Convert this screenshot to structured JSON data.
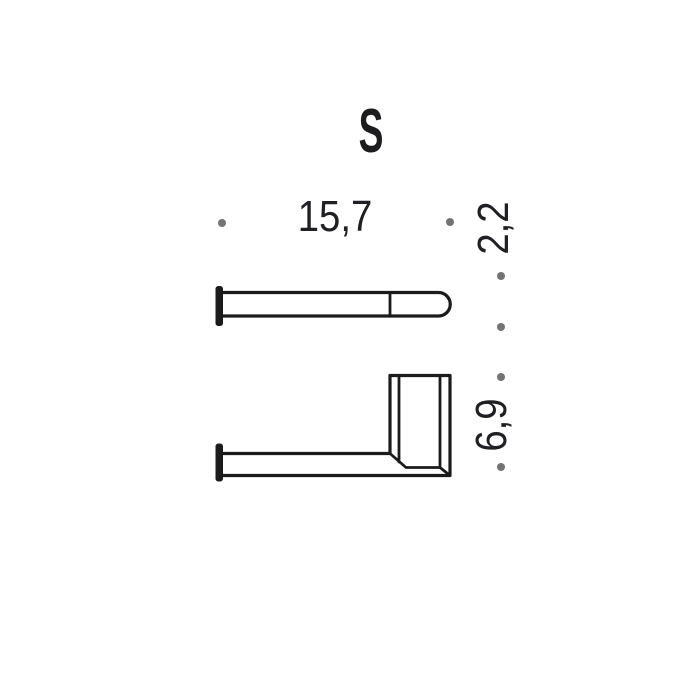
{
  "title": {
    "label": "S"
  },
  "dimensions": {
    "length": {
      "label": "15,7"
    },
    "depth": {
      "label": "2,2"
    },
    "height": {
      "label": "6,9"
    }
  },
  "drawing": {
    "views": [
      {
        "name": "top-view",
        "parts": [
          "wall-plate",
          "bar",
          "end-cap-divider",
          "rounded-end"
        ]
      },
      {
        "name": "side-view",
        "parts": [
          "wall-plate",
          "arm",
          "vertical-plate"
        ]
      }
    ],
    "colors": {
      "line": "#1b1b1b",
      "text": "#202024",
      "dot": "#747474",
      "background": "#ffffff"
    }
  }
}
